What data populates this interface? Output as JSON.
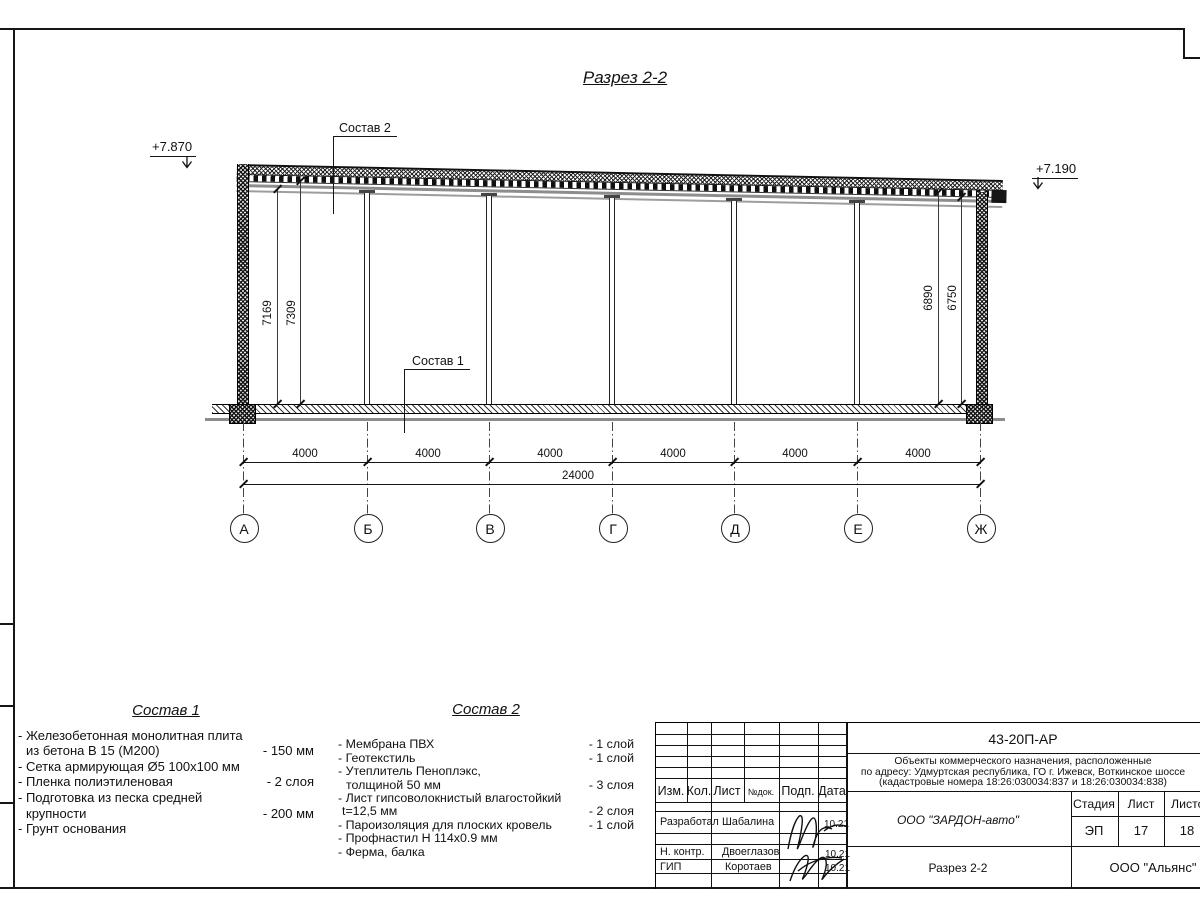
{
  "sheet": {
    "title": "Разрез 2-2",
    "elevation_left": "+7.870",
    "elevation_right": "+7.190",
    "callouts": {
      "roof": "Состав 2",
      "floor": "Состав 1"
    },
    "dims": {
      "left": [
        "7169",
        "7309"
      ],
      "right": [
        "6890",
        "6750"
      ],
      "bays": [
        "4000",
        "4000",
        "4000",
        "4000",
        "4000",
        "4000"
      ],
      "total": "24000"
    },
    "axes": [
      "А",
      "Б",
      "В",
      "Г",
      "Д",
      "Е",
      "Ж"
    ]
  },
  "sostav1": {
    "title": "Состав 1",
    "items": [
      {
        "line1": "- Железобетонная  монолитная плита",
        "line2": "из бетона В 15 (М200)",
        "value": "- 150 мм"
      },
      {
        "line1": "- Сетка армирующая Ø5 100х100 мм"
      },
      {
        "line1": "- Пленка полиэтиленовая",
        "value": "-  2 слоя"
      },
      {
        "line1": "- Подготовка из песка средней",
        "line2": "крупности",
        "value": "- 200 мм"
      },
      {
        "line1": "- Грунт основания"
      }
    ]
  },
  "sostav2": {
    "title": "Состав 2",
    "items": [
      {
        "line1": "- Мембрана ПВХ",
        "value": "- 1 слой"
      },
      {
        "line1": "- Геотекстиль",
        "value": "- 1 слой"
      },
      {
        "line1": "- Утеплитель Пеноплэкс,",
        "line2": "толщиной 50 мм",
        "value": "- 3 слоя"
      },
      {
        "line1": "- Лист гипсоволокнистый влагостойкий",
        "line2": "t=12,5 мм",
        "value": "- 2 слоя"
      },
      {
        "line1": "- Пароизоляция для плоских кровель",
        "value": "- 1 слой"
      },
      {
        "line1": "- Профнастил Н 114х0.9 мм"
      },
      {
        "line1": "- Ферма, балка"
      }
    ]
  },
  "titleblock": {
    "doc_code": "43-20П-АР",
    "description": [
      "Объекты коммерческого назначения, расположенные",
      "по адресу: Удмуртская республика, ГО г. Ижевск, Воткинское шоссе",
      "(кадастровые номера 18:26:030034:837 и 18:26:030034:838)"
    ],
    "columns": [
      "Изм.",
      "Кол.",
      "Лист",
      "№док.",
      "Подп.",
      "Дата"
    ],
    "rows": [
      {
        "role": "Разработал",
        "name": "Шабалина",
        "date": "10.21"
      },
      {
        "role": "Н. контр.",
        "name": "Двоеглазов",
        "date": "10.21"
      },
      {
        "role": "ГИП",
        "name": "Коротаев",
        "date": "10.21"
      }
    ],
    "designer": "ООО \"ЗАРДОН-авто\"",
    "stage_label": "Стадия",
    "sheet_label": "Лист",
    "sheets_label": "Листов",
    "stage": "ЭП",
    "sheet": "17",
    "sheets": "18",
    "drawing_name": "Разрез 2-2",
    "contractor": "ООО \"Альянс\""
  },
  "colors": {
    "ink": "#111111",
    "secondary_line": "#8c8c8c"
  }
}
